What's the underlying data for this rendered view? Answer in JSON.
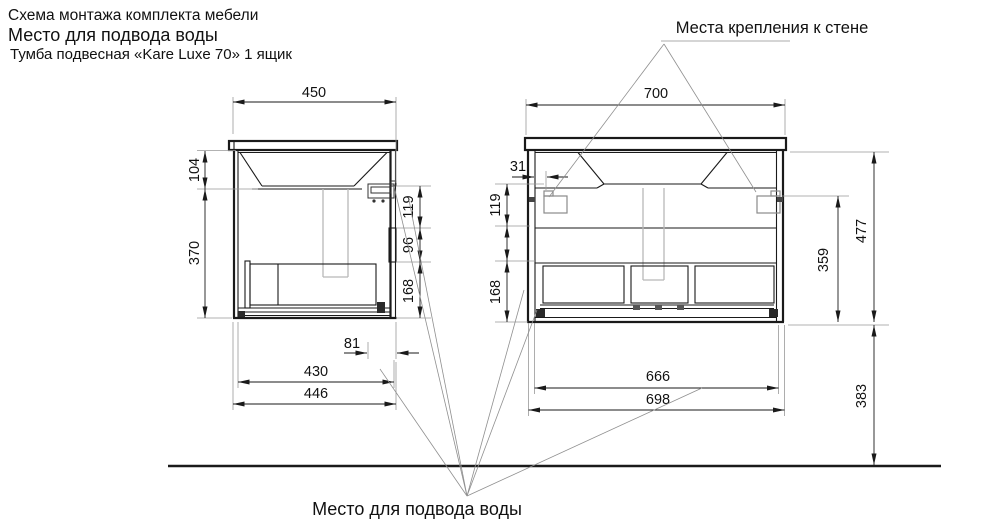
{
  "title": {
    "line1": "Схема монтажа комплекта мебели",
    "line2": "Место для подвода воды",
    "line3": "Тумба подвесная «Kare Luxe 70» 1 ящик"
  },
  "annotations": {
    "wall_mount": "Места крепления к стене",
    "water_supply": "Место для подвода воды"
  },
  "side_view": {
    "d450": "450",
    "d104": "104",
    "d370": "370",
    "d119": "119",
    "d96": "96",
    "d168": "168",
    "d81": "81",
    "d430": "430",
    "d446": "446"
  },
  "front_view": {
    "d700": "700",
    "d31": "31",
    "d119": "119",
    "d168": "168",
    "d666": "666",
    "d698": "698",
    "d359": "359",
    "d477": "477",
    "d383": "383"
  },
  "colors": {
    "line": "#1a1a1a",
    "extension": "#999999",
    "drain_pipe": "#b8b8b8",
    "text": "#111111"
  }
}
